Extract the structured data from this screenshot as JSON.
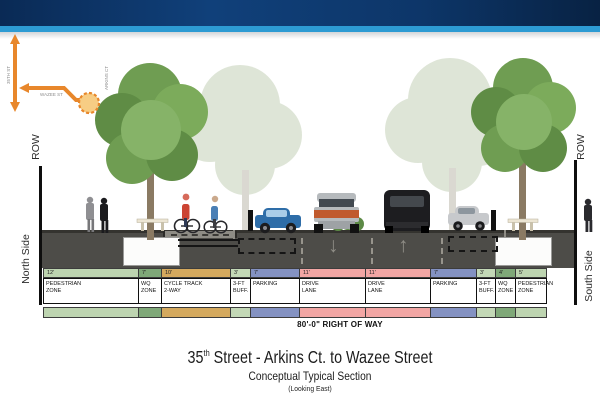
{
  "header": {
    "bar_color": "#0d3669",
    "stripe_color": "#2d9bd3"
  },
  "locator": {
    "accent_color": "#e8872b",
    "vertical_street": "35TH ST",
    "horizontal_street": "WAZEE ST",
    "cross_street": "ARKINS CT"
  },
  "row_markers": {
    "left_row": "ROW",
    "right_row": "ROW",
    "left_side": "North Side",
    "right_side": "South Side"
  },
  "road": {
    "lane_arrow_left": "↓",
    "lane_arrow_right": "↑"
  },
  "section": {
    "zones": [
      {
        "dim": "12'",
        "label": [
          "PEDESTRIAN",
          "ZONE"
        ],
        "color": "#bdd4b0",
        "w": 96
      },
      {
        "dim": "7'",
        "label": [
          "WQ",
          "ZONE"
        ],
        "color": "#7fa878",
        "w": 24
      },
      {
        "dim": "10'",
        "label": [
          "CYCLE TRACK",
          "2-WAY"
        ],
        "color": "#d4a95e",
        "w": 70
      },
      {
        "dim": "3'",
        "label": [
          "3-FT",
          "BUFF."
        ],
        "color": "#c3d8b6",
        "w": 21
      },
      {
        "dim": "7'",
        "label": [
          "PARKING"
        ],
        "color": "#8492c2",
        "w": 50
      },
      {
        "dim": "11'",
        "label": [
          "DRIVE",
          "LANE"
        ],
        "color": "#f2a6a4",
        "w": 67
      },
      {
        "dim": "11'",
        "label": [
          "DRIVE",
          "LANE"
        ],
        "color": "#f2a6a4",
        "w": 66
      },
      {
        "dim": "7'",
        "label": [
          "PARKING"
        ],
        "color": "#8492c2",
        "w": 47
      },
      {
        "dim": "3'",
        "label": [
          "3-FT",
          "BUFF."
        ],
        "color": "#c3d8b6",
        "w": 20
      },
      {
        "dim": "4'",
        "label": [
          "WQ",
          "ZONE"
        ],
        "color": "#7fa878",
        "w": 21
      },
      {
        "dim": "5'",
        "label": [
          "PEDESTRIAN",
          "ZONE"
        ],
        "color": "#bdd4b0",
        "w": 32
      }
    ],
    "right_of_way": "80'-0\" RIGHT OF WAY"
  },
  "titles": {
    "main_prefix": "35",
    "main_sup": "th",
    "main_rest": " Street - Arkins Ct. to Wazee Street",
    "subtitle": "Conceptual Typical Section",
    "note": "(Looking East)"
  }
}
